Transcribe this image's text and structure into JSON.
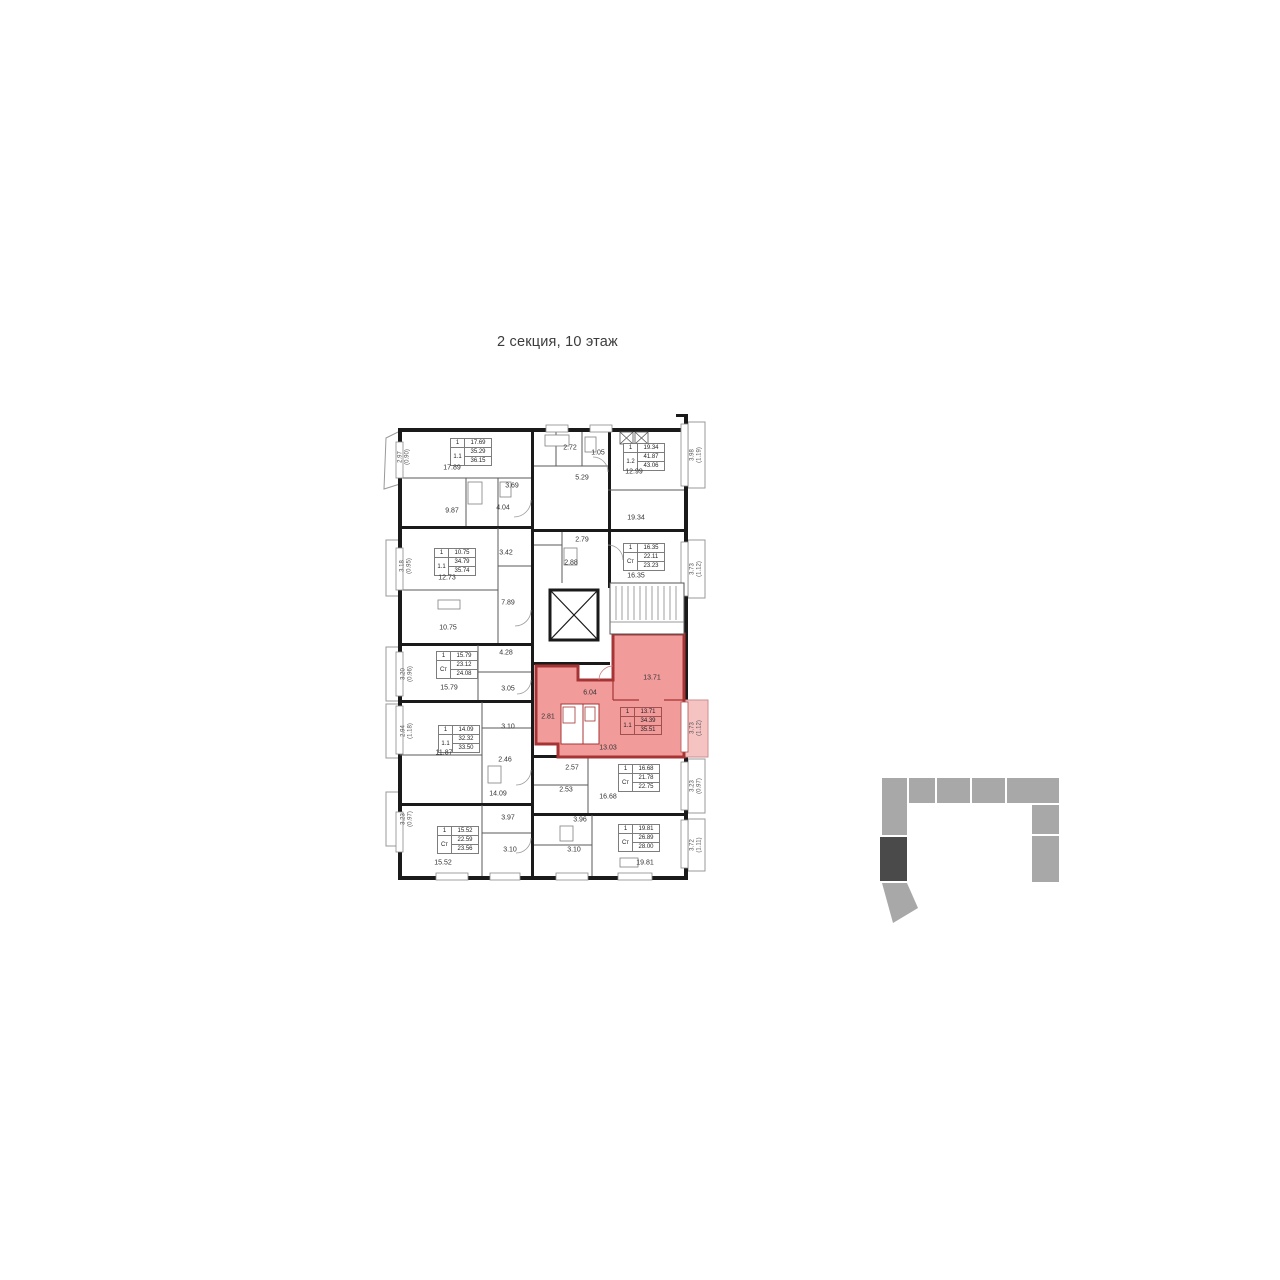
{
  "title": "2 секция, 10 этаж",
  "legend": {
    "section_label": "2 секция",
    "floor_label": "10 этаж"
  },
  "colors": {
    "highlight_fill": "#F29B9B",
    "highlight_wall": "#A63434",
    "highlight_balcony": "#F6C3C3",
    "wall": "#1a1a1a",
    "keyplan_gray": "#a8a8a8",
    "keyplan_current": "#4a4a4a"
  },
  "apartments": [
    {
      "side": "left",
      "rooms": "1",
      "living": "17.69",
      "area": "35.29",
      "type": "1.1",
      "total": "36.15",
      "balcony": "2.97",
      "balcony_coef": "(0.90)"
    },
    {
      "side": "left",
      "rooms": "1",
      "living": "10.75",
      "area": "34.79",
      "type": "1.1",
      "total": "35.74",
      "balcony": "3.18",
      "balcony_coef": "(0.95)"
    },
    {
      "side": "left",
      "rooms": "1",
      "living": "15.79",
      "area": "23.12",
      "type": "Ст",
      "total": "24.08",
      "balcony": "3.20",
      "balcony_coef": "(0.96)"
    },
    {
      "side": "left",
      "rooms": "1",
      "living": "14.09",
      "area": "32.32",
      "type": "1.1",
      "total": "33.50",
      "balcony": "2.94",
      "balcony_coef": "(1.18)"
    },
    {
      "side": "left",
      "rooms": "1",
      "living": "15.52",
      "area": "22.59",
      "type": "Ст",
      "total": "23.56",
      "balcony": "3.23",
      "balcony_coef": "(0.97)"
    },
    {
      "side": "right",
      "rooms": "1",
      "living": "19.34",
      "area": "41.87",
      "type": "1.2",
      "total": "43.06",
      "balcony": "3.98",
      "balcony_coef": "(1.19)"
    },
    {
      "side": "right",
      "rooms": "1",
      "living": "16.35",
      "area": "22.11",
      "type": "Ст",
      "total": "23.23",
      "balcony": "3.73",
      "balcony_coef": "(1.12)"
    },
    {
      "side": "right",
      "rooms": "1",
      "living": "13.71",
      "area": "34.39",
      "type": "1.1",
      "total": "35.51",
      "balcony": "3.73",
      "balcony_coef": "(1.12)",
      "highlighted": true
    },
    {
      "side": "right",
      "rooms": "1",
      "living": "16.68",
      "area": "21.78",
      "type": "Ст",
      "total": "22.75",
      "balcony": "3.23",
      "balcony_coef": "(0.97)"
    },
    {
      "side": "right",
      "rooms": "1",
      "living": "19.81",
      "area": "26.89",
      "type": "Ст",
      "total": "28.00",
      "balcony": "3.72",
      "balcony_coef": "(1.11)"
    }
  ],
  "room_labels": [
    "17.89",
    "3.69",
    "9.87",
    "4.04",
    "2.72",
    "1.05",
    "5.29",
    "12.99",
    "19.34",
    "3.42",
    "12.73",
    "7.89",
    "10.75",
    "2.79",
    "2.88",
    "16.35",
    "4.28",
    "15.79",
    "3.05",
    "6.04",
    "13.71",
    "2.81",
    "3.10",
    "13.03",
    "11.87",
    "2.46",
    "14.09",
    "2.57",
    "2.53",
    "16.68",
    "3.97",
    "3.96",
    "3.10",
    "3.10",
    "15.52",
    "19.81"
  ]
}
